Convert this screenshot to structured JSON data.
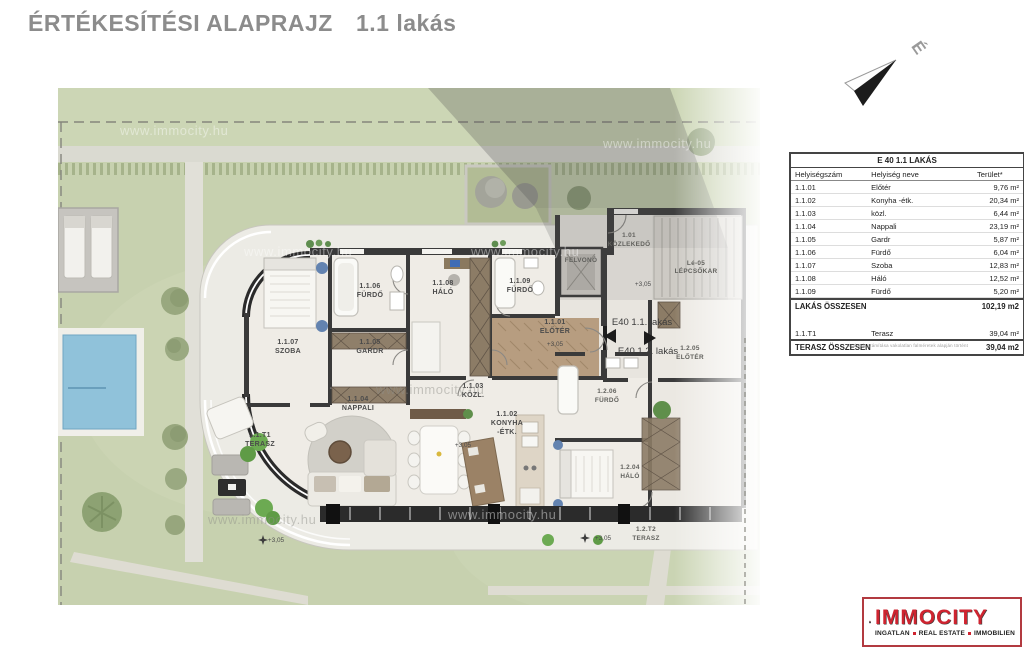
{
  "page": {
    "title": "ÉRTÉKESÍTÉSI ALAPRAJZ",
    "apartment": "1.1 lakás"
  },
  "compass": {
    "north_label": "É"
  },
  "table": {
    "title": "E 40 1.1 LAKÁS",
    "columns": [
      "Helyiségszám",
      "Helyiség neve",
      "Terület*"
    ],
    "rows": [
      {
        "id": "1.1.01",
        "name": "Előtér",
        "area": "9,76 m²"
      },
      {
        "id": "1.1.02",
        "name": "Konyha -étk.",
        "area": "20,34 m²"
      },
      {
        "id": "1.1.03",
        "name": "közl.",
        "area": "6,44 m²"
      },
      {
        "id": "1.1.04",
        "name": "Nappali",
        "area": "23,19 m²"
      },
      {
        "id": "1.1.05",
        "name": "Gardr",
        "area": "5,87 m²"
      },
      {
        "id": "1.1.06",
        "name": "Fürdő",
        "area": "6,04 m²"
      },
      {
        "id": "1.1.07",
        "name": "Szoba",
        "area": "12,83 m²"
      },
      {
        "id": "1.1.08",
        "name": "Háló",
        "area": "12,52 m²"
      },
      {
        "id": "1.1.09",
        "name": "Fürdő",
        "area": "5,20 m²"
      }
    ],
    "apartment_total": {
      "label": "LAKÁS ÖSSZESEN",
      "value": "102,19 m2"
    },
    "terrace_row": {
      "id": "1.1.T1",
      "name": "Terasz",
      "area": "39,04 m²"
    },
    "terrace_total": {
      "label": "TERASZ ÖSSZESEN",
      "value": "39,04 m2"
    },
    "footnote": "Területek számítása vakolatlan falméretek alapján történt"
  },
  "plan": {
    "watermark": "www.immocity.hu",
    "level_mark": "+3,05",
    "unit_markers": [
      "E40 1.1. lakás",
      "E40 1.2. lakás"
    ],
    "rooms": [
      {
        "id": "1.1.01",
        "name": "ELŐTÉR"
      },
      {
        "id": "1.1.02",
        "name": "KONYHA",
        "name2": "-ÉTK."
      },
      {
        "id": "1.1.03",
        "name": "KÖZL."
      },
      {
        "id": "1.1.04",
        "name": "NAPPALI"
      },
      {
        "id": "1.1.05",
        "name": "GARDR"
      },
      {
        "id": "1.1.06",
        "name": "FÜRDŐ"
      },
      {
        "id": "1.1.07",
        "name": "SZOBA"
      },
      {
        "id": "1.1.08",
        "name": "HÁLÓ"
      },
      {
        "id": "1.1.09",
        "name": "FÜRDŐ"
      },
      {
        "id": "1.1.T1",
        "name": "TERASZ"
      },
      {
        "id": "1.2.06",
        "name": "FÜRDŐ"
      },
      {
        "id": "1.2.04",
        "name": "HÁLÓ"
      },
      {
        "id": "1.2.T2",
        "name": "TERASZ"
      },
      {
        "id": "1.2.05",
        "name": "ELŐTÉR"
      },
      {
        "id": "1.01",
        "name": "KÖZLEKEDŐ"
      },
      {
        "id": "",
        "name": "FELVONÓ"
      },
      {
        "id": "Lé-05",
        "name": "LÉPCSŐKAR"
      }
    ]
  },
  "logo": {
    "name": "IMMOCITY",
    "words": [
      "INGATLAN",
      "REAL ESTATE",
      "IMMOBILIEN"
    ],
    "brand_red": "#cf2430"
  }
}
